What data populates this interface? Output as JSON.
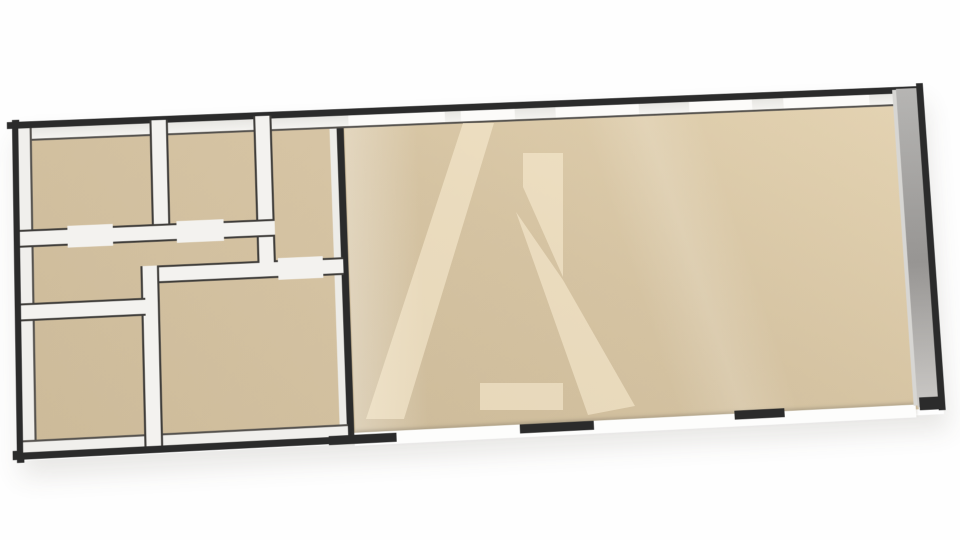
{
  "scene": {
    "description": "3D rendered floor plan viewed from above at a slight tilt: six small rooms on the left block, one large open room on the right, beige floors, dark walls with white top faces, gray outer right wall, translucent A-shaped logo watermark over the main room",
    "image_width": 960,
    "image_height": 540
  },
  "palette": {
    "background": "#fefefe",
    "wall_dark": "#2b2b2b",
    "wall_top_face": "#f3f2ef",
    "wall_inner_edge": "#4a4a4a",
    "floor_beige": "#d2c0a0",
    "floor_beige_light": "#e0cfae",
    "side_wall_gray": "#989593",
    "watermark_fill": "#fff3da"
  },
  "plan": {
    "width": 910,
    "height": 340,
    "elements": [
      {
        "name": "left-block-floor",
        "cls": "floor-left",
        "x": 4,
        "y": 4,
        "w": 322,
        "h": 331
      },
      {
        "name": "main-room-floor",
        "cls": "floor-main",
        "x": 325,
        "y": 4,
        "w": 560,
        "h": 330
      },
      {
        "name": "floor-light-streak",
        "cls": "streak-a",
        "x": 326,
        "y": 4,
        "w": 90,
        "h": 330
      },
      {
        "name": "floor-light-streak-2",
        "cls": "streak-b",
        "x": 560,
        "y": 4,
        "w": 200,
        "h": 330
      },
      {
        "name": "divider-wall-trim",
        "cls": "trim",
        "x": 311,
        "y": 6,
        "w": 8,
        "h": 324
      },
      {
        "name": "divider-wall",
        "cls": "dark",
        "x": 318,
        "y": 0,
        "w": 7,
        "h": 336
      },
      {
        "name": "outer-wall-top-dark",
        "cls": "dark",
        "x": -5,
        "y": 0,
        "w": 916,
        "h": 7
      },
      {
        "name": "outer-wall-top-face",
        "cls": "face face-b",
        "x": 5,
        "y": 7,
        "w": 899,
        "h": 13
      },
      {
        "name": "outer-wall-left-dark",
        "cls": "dark",
        "x": 0,
        "y": -2,
        "w": 7,
        "h": 344
      },
      {
        "name": "outer-wall-left-face",
        "cls": "face face-r",
        "x": 6,
        "y": 7,
        "w": 13,
        "h": 323
      },
      {
        "name": "leftblock-bottom-dark",
        "cls": "dark",
        "x": -4,
        "y": 330,
        "w": 338,
        "h": 9
      },
      {
        "name": "leftblock-bottom-face",
        "cls": "face face-t",
        "x": 6,
        "y": 320,
        "w": 313,
        "h": 12
      },
      {
        "name": "window-segment-1",
        "cls": "window",
        "x": 330,
        "y": 7,
        "w": 96,
        "h": 11
      },
      {
        "name": "window-segment-2",
        "cls": "window",
        "x": 442,
        "y": 7,
        "w": 54,
        "h": 11
      },
      {
        "name": "window-segment-3",
        "cls": "window",
        "x": 537,
        "y": 7,
        "w": 84,
        "h": 11
      },
      {
        "name": "window-segment-4",
        "cls": "window",
        "x": 672,
        "y": 7,
        "w": 64,
        "h": 11
      },
      {
        "name": "window-segment-5",
        "cls": "window",
        "x": 768,
        "y": 7,
        "w": 88,
        "h": 11
      },
      {
        "name": "wall-f-top",
        "cls": "wall-h",
        "x": 122,
        "y": 152,
        "w": 198,
        "h": 18
      },
      {
        "name": "wall-e-f",
        "cls": "wall-v",
        "x": 122,
        "y": 152,
        "w": 18,
        "h": 180
      },
      {
        "name": "wall-a-b",
        "cls": "wall-v",
        "x": 134,
        "y": 4,
        "w": 18,
        "h": 110
      },
      {
        "name": "wall-b-c",
        "cls": "wall-v",
        "x": 236,
        "y": 4,
        "w": 18,
        "h": 150
      },
      {
        "name": "wall-under-ab",
        "cls": "wall-h",
        "x": 6,
        "y": 110,
        "w": 248,
        "h": 18
      },
      {
        "name": "wall-above-e",
        "cls": "wall-h",
        "x": 6,
        "y": 184,
        "w": 120,
        "h": 18
      },
      {
        "name": "door-opening-1",
        "cls": "opening",
        "x": 52,
        "y": 108,
        "w": 44,
        "h": 22
      },
      {
        "name": "door-opening-2",
        "cls": "opening",
        "x": 158,
        "y": 108,
        "w": 46,
        "h": 22
      },
      {
        "name": "door-opening-3",
        "cls": "opening",
        "x": 256,
        "y": 150,
        "w": 44,
        "h": 22
      },
      {
        "name": "main-bottom-face",
        "cls": "bottomband",
        "x": 325,
        "y": 329,
        "w": 557,
        "h": 13
      },
      {
        "name": "bottom-wall-segment-1",
        "cls": "dark",
        "x": 300,
        "y": 331,
        "w": 66,
        "h": 9
      },
      {
        "name": "bottom-wall-segment-2",
        "cls": "dark",
        "x": 487,
        "y": 329,
        "w": 73,
        "h": 9
      },
      {
        "name": "bottom-wall-segment-3",
        "cls": "dark",
        "x": 700,
        "y": 326,
        "w": 50,
        "h": 9
      },
      {
        "name": "right-wall-inner-edge",
        "cls": "edge-light",
        "x": 880,
        "y": 3,
        "w": 6,
        "h": 327
      },
      {
        "name": "right-wall-face",
        "cls": "sideface",
        "x": 884,
        "y": 2,
        "w": 22,
        "h": 330
      },
      {
        "name": "right-wall-dark",
        "cls": "dark",
        "x": 905,
        "y": -3,
        "w": 7,
        "h": 339
      },
      {
        "name": "bottom-right-corner",
        "cls": "dark",
        "x": 886,
        "y": 322,
        "w": 26,
        "h": 13
      },
      {
        "name": "room-top-left",
        "cls": "room",
        "x": 18,
        "y": 20,
        "w": 114,
        "h": 88
      },
      {
        "name": "room-top-middle",
        "cls": "room",
        "x": 154,
        "y": 20,
        "w": 80,
        "h": 88
      },
      {
        "name": "room-top-right",
        "cls": "room",
        "x": 256,
        "y": 20,
        "w": 53,
        "h": 128
      },
      {
        "name": "hallway",
        "cls": "room",
        "x": 18,
        "y": 130,
        "w": 216,
        "h": 52
      },
      {
        "name": "room-bottom-left",
        "cls": "room",
        "x": 18,
        "y": 204,
        "w": 102,
        "h": 112
      },
      {
        "name": "room-bottom-middle",
        "cls": "room",
        "x": 142,
        "y": 172,
        "w": 167,
        "h": 144
      },
      {
        "name": "main-room",
        "cls": "room",
        "x": 330,
        "y": 22,
        "w": 535,
        "h": 300
      }
    ]
  },
  "watermark": {
    "fill": "#fff3da",
    "opacity": 0.5,
    "polygons": [
      {
        "name": "watermark-left-stroke",
        "points": "133,11 164,11 74,307 36,307"
      },
      {
        "name": "watermark-vertical-bar",
        "points": "193,41 233,41 233,165 193,75"
      },
      {
        "name": "watermark-right-leg",
        "points": "186,100 233,168 305,294 258,303"
      },
      {
        "name": "watermark-foot",
        "points": "150,271 233,271 233,298 150,298"
      }
    ]
  }
}
